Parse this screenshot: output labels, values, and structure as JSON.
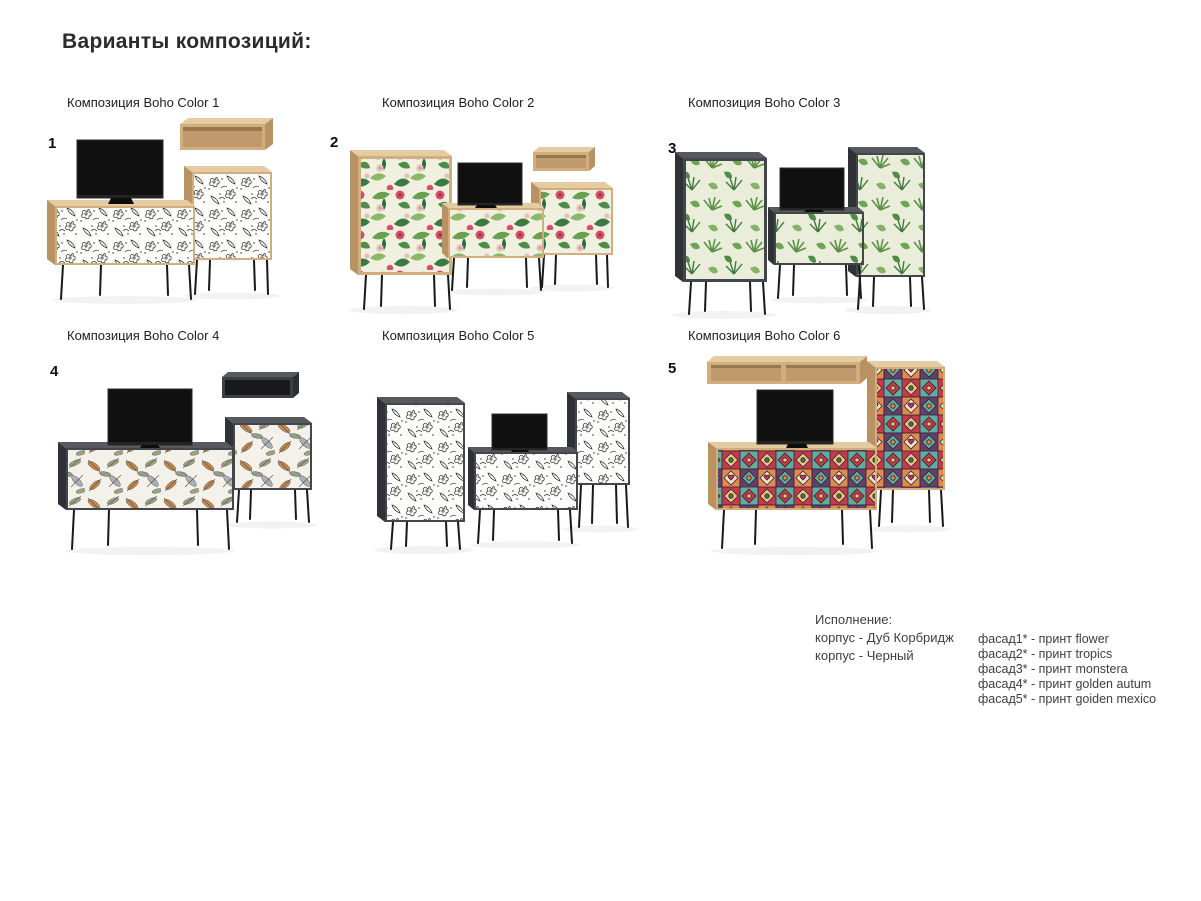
{
  "page": {
    "title": "Варианты композиций:"
  },
  "compositions": [
    {
      "number": "1",
      "label": "Композиция Boho Color 1",
      "body": "oak",
      "print": "flower"
    },
    {
      "number": "2",
      "label": "Композиция Boho Color 2",
      "body": "oak",
      "print": "tropics"
    },
    {
      "number": "3",
      "label": "Композиция Boho Color 3",
      "body": "dark",
      "print": "monstera"
    },
    {
      "number": "4",
      "label": "Композиция Boho Color 4",
      "body": "dark",
      "print": "golden autum"
    },
    {
      "number": "",
      "label": "Композиция Boho Color 5",
      "body": "dark",
      "print": "flower"
    },
    {
      "number": "5",
      "label": "Композиция Boho Color 6",
      "body": "oak",
      "print": "goiden mexico"
    }
  ],
  "legend": {
    "title": "Исполнение:",
    "body_lines": [
      "корпус - Дуб Корбридж",
      "корпус - Черный"
    ],
    "facade_lines": [
      "фасад1* - принт flower",
      "фасад2* - принт tropics",
      "фасад3* - принт monstera",
      "фасад4* - принт golden autum",
      "фасад5* - принт goiden mexico"
    ]
  },
  "colors": {
    "oak_front": "#d2ae7e",
    "oak_top": "#e5cba1",
    "oak_side": "#b99264",
    "dark_front": "#43474c",
    "dark_top": "#565a5f",
    "dark_side": "#2e3135",
    "tv_screen": "#101010",
    "legs": "#17181a"
  }
}
